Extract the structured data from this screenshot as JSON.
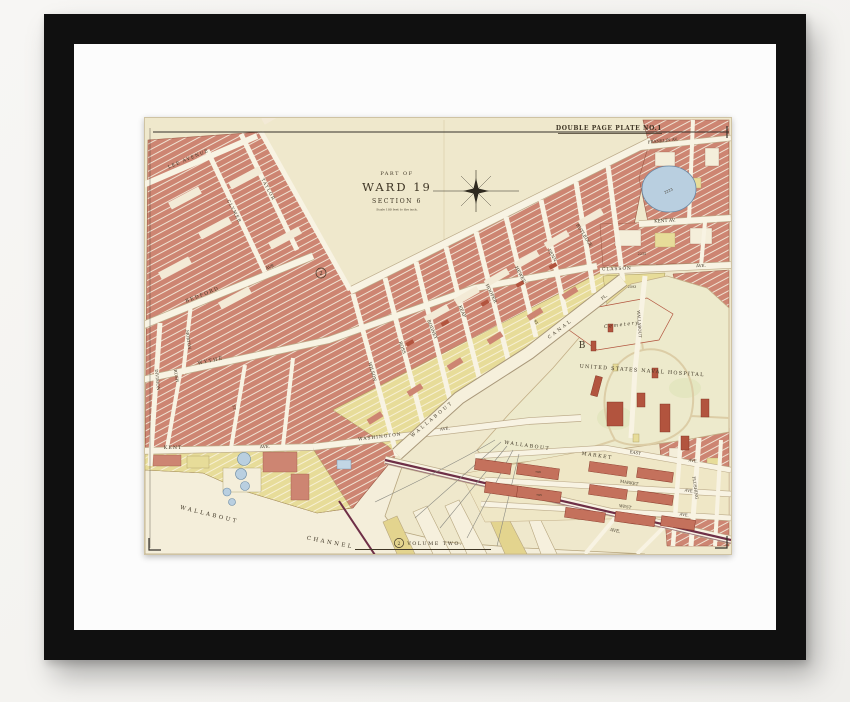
{
  "plate": {
    "plate_number": "DOUBLE PAGE PLATE NO.1",
    "title_line1": "PART OF",
    "title_line2": "WARD 19",
    "title_line3": "SECTION 6",
    "title_scale": "Scale 100 feet to the inch.",
    "volume_label": "VOLUME TWO.",
    "volume_number": "2",
    "area_marker": "2",
    "block_marker_b": "B"
  },
  "streets": {
    "lee": "LEE AVENUE",
    "taylor": "TAYLOR",
    "clymer": "CLYMER",
    "bedford": "BEDFORD",
    "bedford_ave": "AVE.",
    "morton": "MORTON",
    "rush": "RUSH",
    "division": "DIVISION",
    "wythe": "WYTHE",
    "kent": "KENT",
    "kent_ave": "AVE.",
    "washington": "WASHINGTON",
    "washington_ave": "AVE.",
    "wilson": "WILSON",
    "ross": "ROSS",
    "rodney": "RODNEY",
    "keap": "KEAP",
    "hooper": "HOOPER",
    "hewes": "HEWES",
    "penn": "PENN",
    "rutledge": "RUTLEDGE",
    "franklin": "FRANKLIN AV.",
    "kent_av_right": "KENT AV.",
    "classon": "CLASSON",
    "classon_ave": "AVE.",
    "wallabout_st": "WALLABOUT",
    "flushing_st": "FLUSHING",
    "flushing_ave": "AVE.",
    "east": "EAST",
    "east_ave": "AVE.",
    "market_st": "MARKET",
    "market_ave": "AVE.",
    "west": "WEST",
    "west_ave": "AVE.",
    "st": "ST."
  },
  "places": {
    "canal_word1": "WALLABOUT",
    "canal_word2": "CANAL",
    "canal_pl": "PL.",
    "channel_word1": "WALLABOUT",
    "channel_word2": "CHANNEL",
    "market_word1": "WALLABOUT",
    "market_word2": "MARKET",
    "hospital": "UNITED STATES NAVAL HOSPITAL",
    "cemetery": "Cemetery"
  },
  "numbers": {
    "pond": "2223",
    "block_a": "2215",
    "block_b": "2593",
    "market_a": "796",
    "market_b": "795"
  },
  "colors": {
    "paper": "#efe8cc",
    "water": "#f4eeda",
    "block_salmon": "#cd8572",
    "building_red": "#b2543e",
    "building_yellow": "#e7dc99",
    "street": "#f8f3e3",
    "hospital_ground": "#edeacc",
    "pond_blue": "#b9cfe0",
    "rail": "#6e2f47",
    "ink": "#3e3525",
    "frame": "#101010",
    "matte": "#fcfcfc"
  }
}
